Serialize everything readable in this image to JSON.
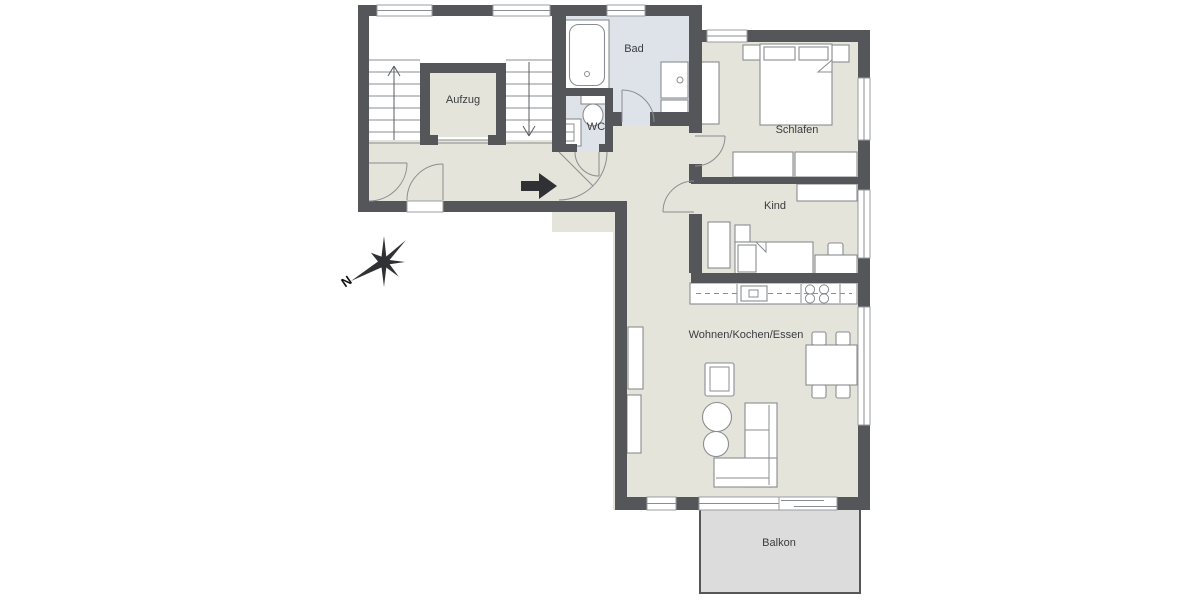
{
  "plan": {
    "rooms": {
      "aufzug": {
        "label": "Aufzug"
      },
      "bad": {
        "label": "Bad"
      },
      "wc": {
        "label": "WC"
      },
      "schlafen": {
        "label": "Schlafen"
      },
      "kind": {
        "label": "Kind"
      },
      "wohnen": {
        "label": "Wohnen/Kochen/Essen"
      },
      "balkon": {
        "label": "Balkon"
      }
    },
    "compass": {
      "north_label": "N"
    },
    "colors": {
      "wall": "#54565a",
      "floor": "#e4e4da",
      "wet_room_floor": "#dee3ea",
      "balcony_floor": "#dcdcdc",
      "stairwell_floor": "#ffffff",
      "outline": "#8a8d91",
      "text": "#3a3c40",
      "arrow": "#2f3134"
    }
  }
}
